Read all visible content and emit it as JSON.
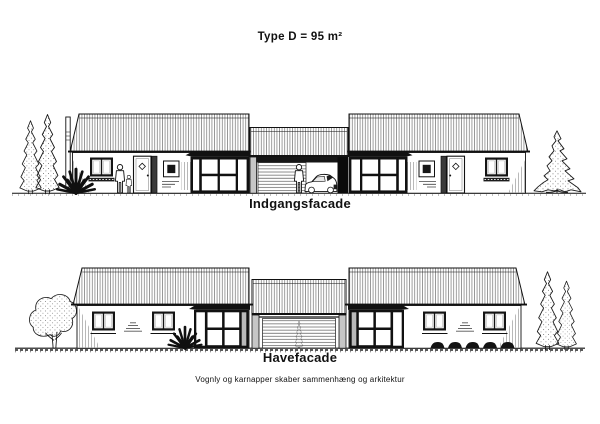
{
  "sheet": {
    "title": "Type D = 95 m²",
    "entrance_label": "Indgangsfacade",
    "garden_label": "Havefacade",
    "caption": "Vognly og karnapper skaber sammenhæng og arkitektur"
  },
  "colors": {
    "ink": "#111111",
    "paper": "#ffffff"
  }
}
